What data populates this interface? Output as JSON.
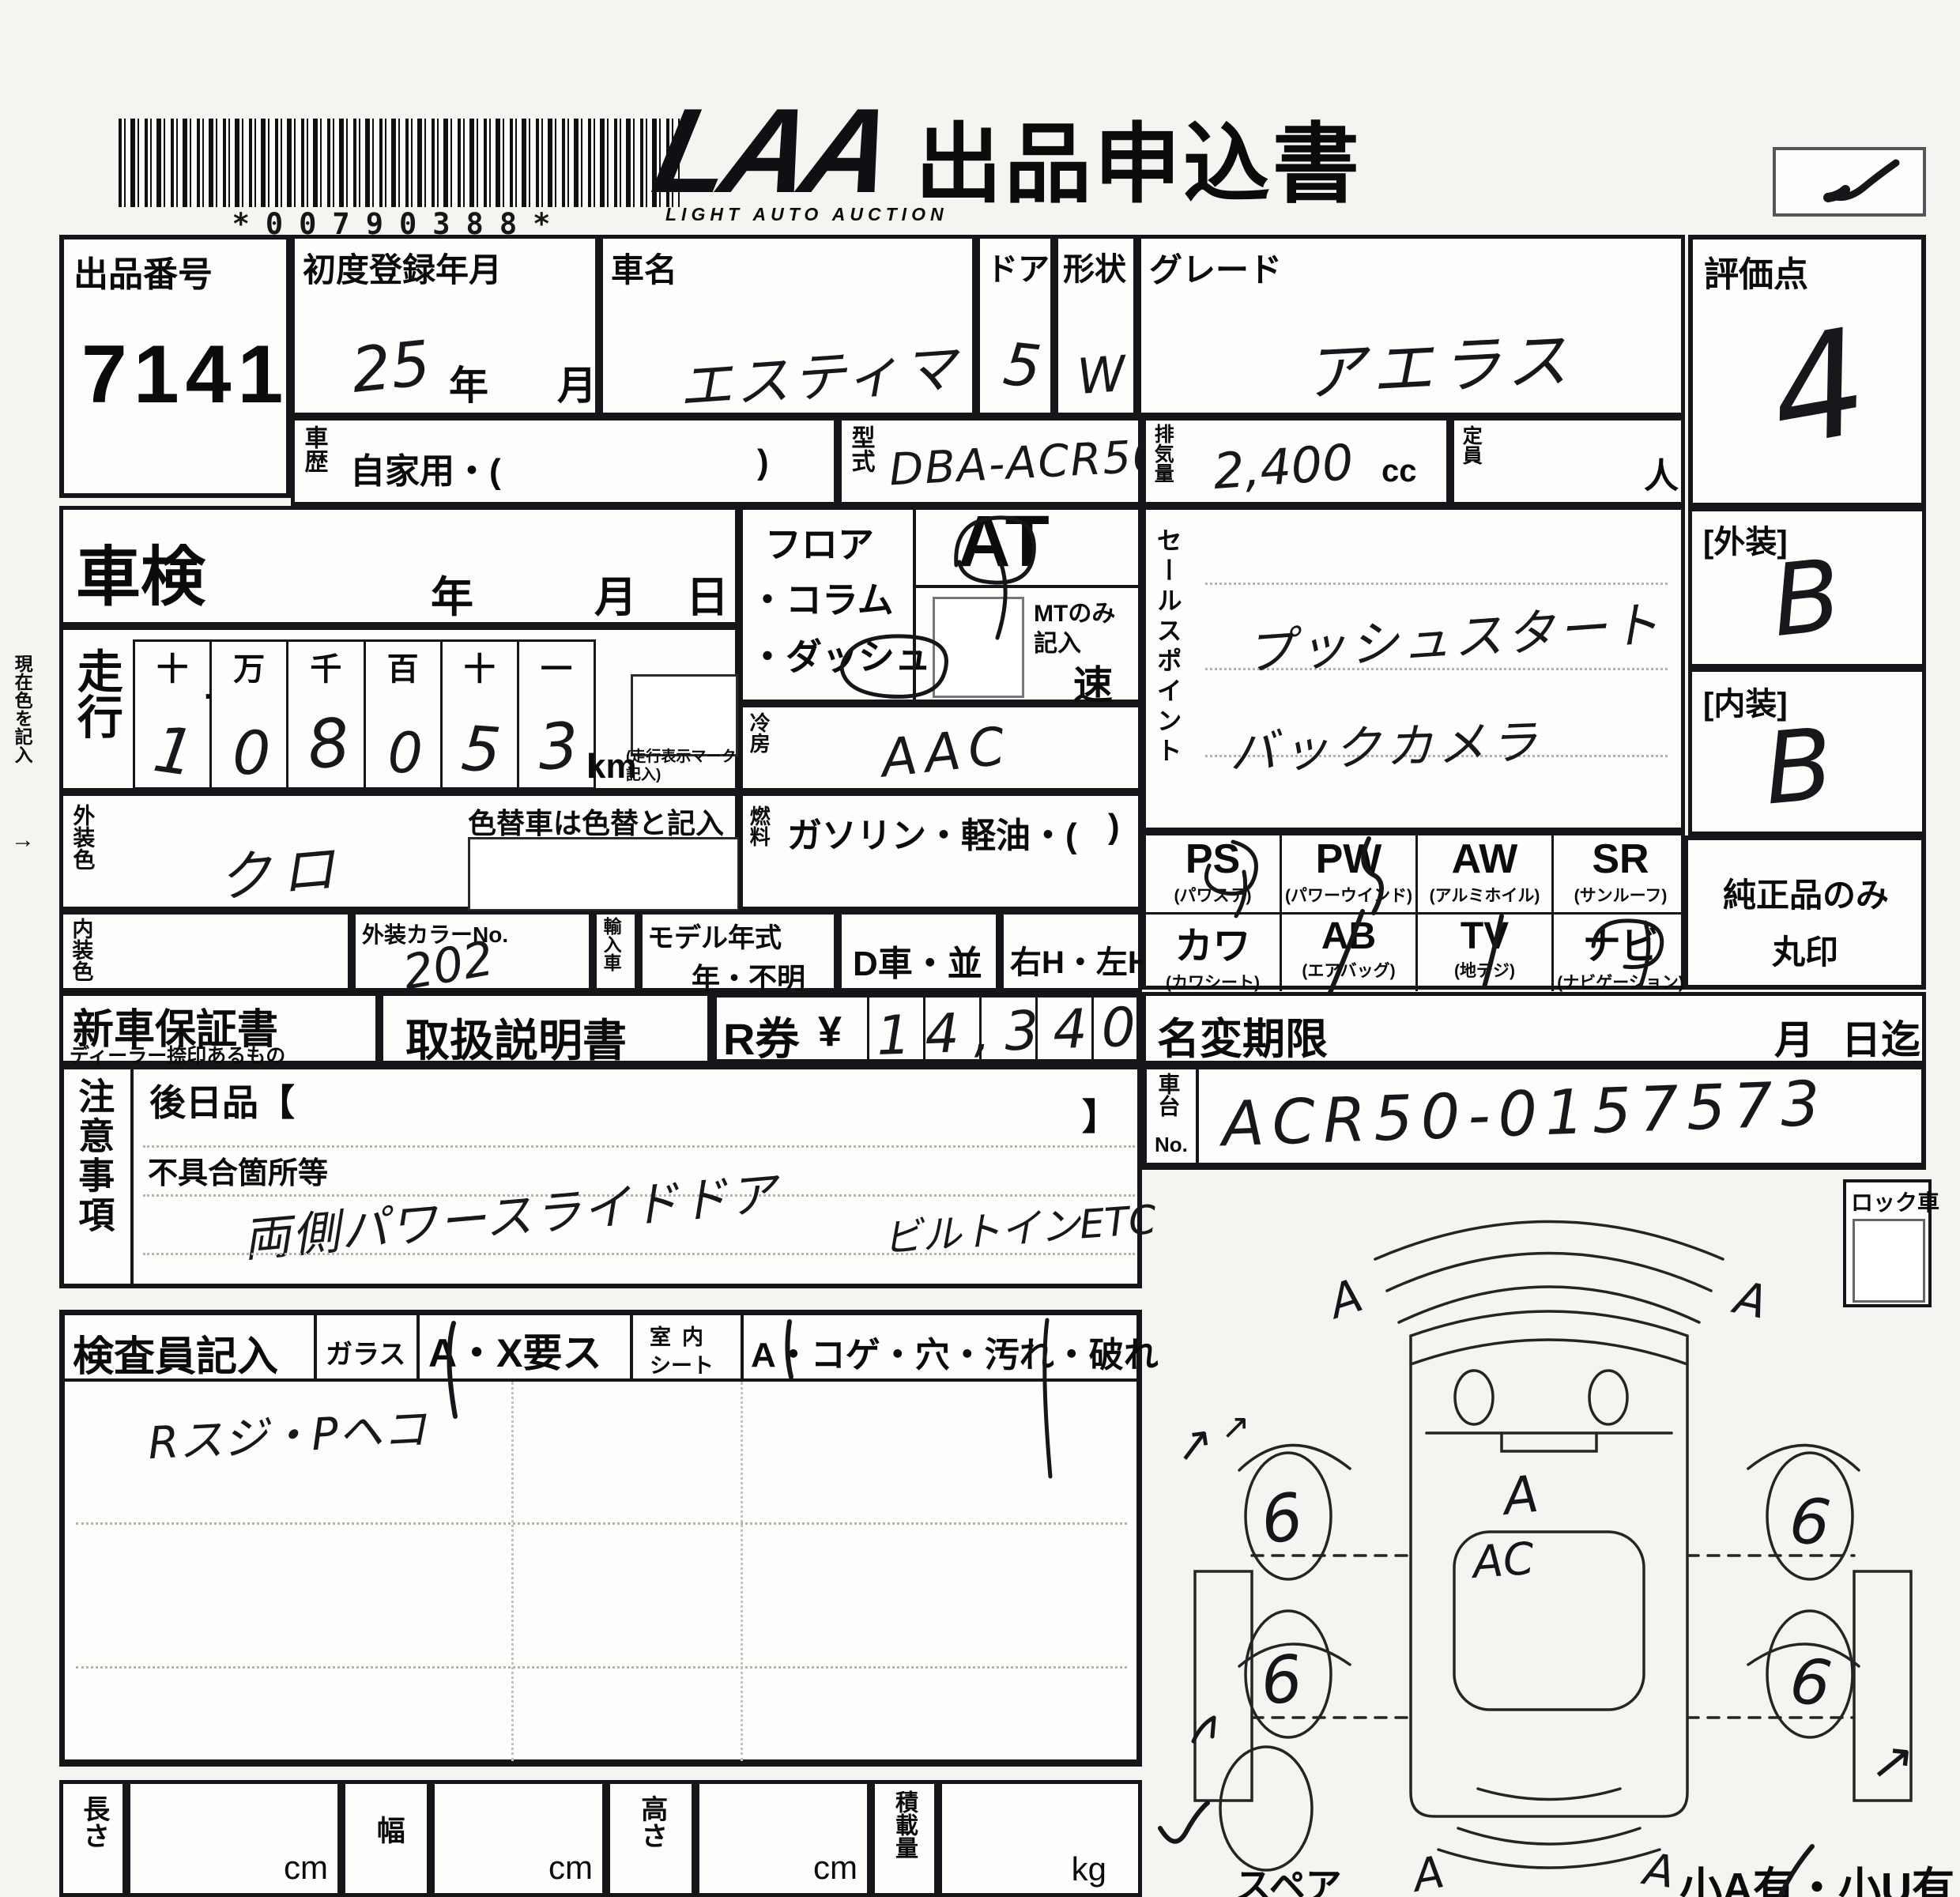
{
  "header": {
    "barcode_text": "*00790388*",
    "logo_main": "LAA",
    "logo_sub": "LIGHT AUTO AUCTION",
    "form_title": "出品申込書"
  },
  "lot": {
    "label": "出品番号",
    "number": "7141"
  },
  "registration": {
    "label": "初度登録年月",
    "value": "25",
    "year": "年",
    "month": "月"
  },
  "car": {
    "label": "車名",
    "value": "エスティマ"
  },
  "door": {
    "label": "ドア",
    "value": "5"
  },
  "shape": {
    "label": "形状",
    "value": "W"
  },
  "grade": {
    "label": "グレード",
    "value": "アエラス"
  },
  "history": {
    "label": "車歴",
    "text": "自家用・(",
    "close": ")"
  },
  "model_code": {
    "label": "型式",
    "value": "DBA-ACR50W"
  },
  "displacement": {
    "label": "排気量",
    "value": "2,400",
    "unit": "cc"
  },
  "capacity": {
    "label": "定員",
    "unit": "人"
  },
  "score": {
    "label": "評価点",
    "value": "4"
  },
  "shaken": {
    "label": "車検",
    "year": "年",
    "month": "月",
    "day": "日"
  },
  "mileage": {
    "label": "走行",
    "headers": [
      "十",
      "万",
      "千",
      "百",
      "十",
      "一"
    ],
    "dot": ".",
    "digits": [
      "1",
      "0",
      "8",
      "0",
      "5",
      "3"
    ],
    "unit": "km",
    "note": "(走行表示マーク記入)"
  },
  "exterior_color": {
    "label": "外装色",
    "value": "クロ",
    "note": "色替車は色替と記入"
  },
  "interior_color": {
    "label": "内装色"
  },
  "color_no": {
    "label": "外装カラーNo.",
    "value": "202"
  },
  "import_car": {
    "label": "輸入車"
  },
  "model_year": {
    "label": "モデル年式",
    "value": "年・不明"
  },
  "d_car": "D車・並",
  "handle": "右H・左H",
  "transmission": {
    "line1": "フロア",
    "line2": "・コラム",
    "line3": "・ダッシュ",
    "at": "AT",
    "mt1": "MTのみ",
    "mt2": "記入",
    "speed": "速"
  },
  "aircon": {
    "label": "冷房",
    "value": "AAC"
  },
  "fuel": {
    "label": "燃料",
    "text": "ガソリン・軽油・(",
    "close": ")"
  },
  "sales_points": {
    "label": "セールスポイント",
    "line1": "プッシュスタート",
    "line2": "バックカメラ"
  },
  "equipment": {
    "row1": [
      {
        "code": "PS",
        "name": "(パワステ)",
        "marked": true
      },
      {
        "code": "PW",
        "name": "(パワーウインド)",
        "marked": true
      },
      {
        "code": "AW",
        "name": "(アルミホイル)",
        "marked": false
      },
      {
        "code": "SR",
        "name": "(サンルーフ)",
        "marked": false
      }
    ],
    "row2": [
      {
        "code": "カワ",
        "name": "(カワシート)",
        "marked": false
      },
      {
        "code": "AB",
        "name": "(エアバッグ)",
        "marked": true
      },
      {
        "code": "TV",
        "name": "(地デジ)",
        "marked": true
      },
      {
        "code": "ナビ",
        "name": "(ナビゲーション)",
        "marked": true
      }
    ]
  },
  "exterior_grade": {
    "label": "[外装]",
    "value": "B"
  },
  "interior_grade": {
    "label": "[内装]",
    "value": "B"
  },
  "genuine_note": {
    "line1": "純正品のみ",
    "line2": "丸印"
  },
  "warranty": {
    "label": "新車保証書",
    "sub": "ディーラー捺印あるもの"
  },
  "manual": {
    "label": "取扱説明書"
  },
  "r_ticket": {
    "label": "R券",
    "currency": "¥",
    "value": "14,340"
  },
  "name_change": {
    "label": "名変期限",
    "month": "月",
    "day": "日迄"
  },
  "cautions": {
    "label": "注意事項",
    "later_item": "後日品【",
    "bracket_close": "】",
    "defect_label": "不具合箇所等",
    "line1": "両側パワースライドドア",
    "line2": "ビルトインETC"
  },
  "chassis": {
    "label_1": "車台",
    "label_2": "No.",
    "value": "ACR50-0157573"
  },
  "lock_car": {
    "label": "ロック車"
  },
  "inspector": {
    "label": "検査員記入",
    "glass": "ガラス",
    "check_a": "A・X要ス",
    "seat_1": "室内",
    "seat_2": "シート",
    "damage": "A・コゲ・穴・汚れ・破れ",
    "note": "Rスジ・Pヘコ"
  },
  "dimensions": {
    "length": "長さ",
    "width": "幅",
    "height": "高さ",
    "load": "積載量",
    "cm": "cm",
    "kg": "kg"
  },
  "spare": {
    "label": "スペア"
  },
  "footer_right": {
    "text": "小A有・小U有"
  },
  "margin_note": {
    "text": "現在色を記入",
    "arrow": "→"
  },
  "diagram": {
    "wheel_mark": "6",
    "corner_mark": "A",
    "hood_mark": "A",
    "center_mark": "AC",
    "arrow_mark": "↗"
  }
}
